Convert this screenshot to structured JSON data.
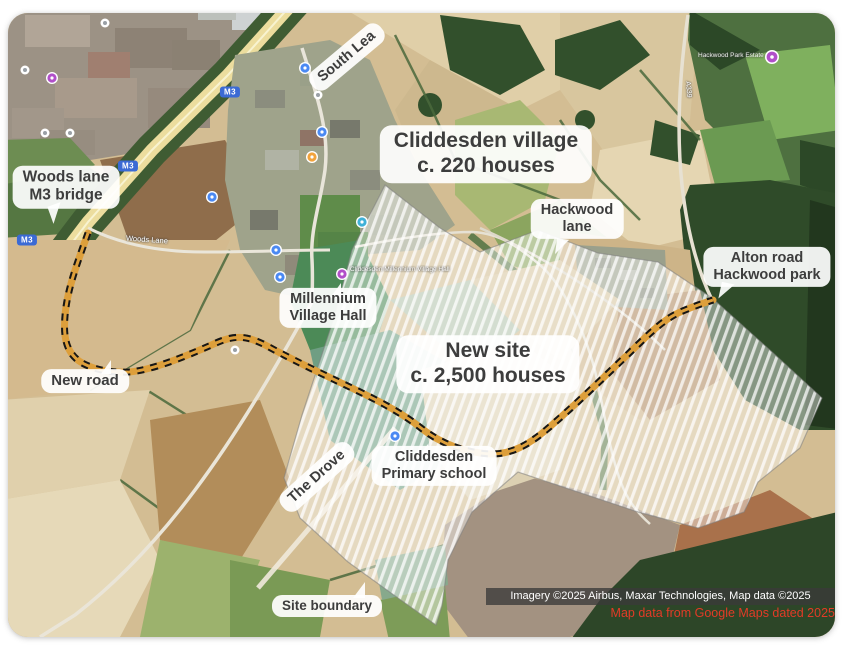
{
  "map": {
    "labels": {
      "woods_lane_bridge": {
        "line1": "Woods lane",
        "line2": "M3 bridge"
      },
      "south_lea": {
        "line1": "South Lea"
      },
      "cliddesden_village": {
        "line1": "Cliddesden village",
        "line2": "c. 220 houses"
      },
      "hackwood_lane": {
        "line1": "Hackwood",
        "line2": "lane"
      },
      "alton_road": {
        "line1": "Alton road",
        "line2": "Hackwood park"
      },
      "new_site": {
        "line1": "New site",
        "line2": "c. 2,500 houses"
      },
      "millennium_hall": {
        "line1": "Millennium",
        "line2": "Village Hall"
      },
      "primary_school": {
        "line1": "Cliddesden",
        "line2": "Primary school"
      },
      "the_drove": {
        "line1": "The Drove"
      },
      "new_road": {
        "line1": "New road"
      },
      "site_boundary": {
        "line1": "Site boundary"
      }
    },
    "street_labels": {
      "m3": "M3",
      "a339": "A339",
      "woods_lane": "Woods Lane",
      "hackwood_park_estate": "Hackwood Park Estate",
      "millennium_poi": "Cliddesden Millennium Village Hall"
    },
    "attribution": "Imagery ©2025 Airbus, Maxar Technologies, Map data ©2025",
    "source_note": "Map data from Google Maps dated 2025",
    "colors": {
      "new_road_orange": "#dd9f3b",
      "new_road_dash": "#161616",
      "site_hatch": "#ffffff",
      "label_text": "#3d3d3d",
      "source_note_red": "#e23b27",
      "pin_blue": "#4a89f3",
      "pin_purple": "#b14fc9",
      "pin_amber": "#f2a33c",
      "pin_teal": "#3fb1d8",
      "shield_blue": "#3b6ad4"
    }
  }
}
